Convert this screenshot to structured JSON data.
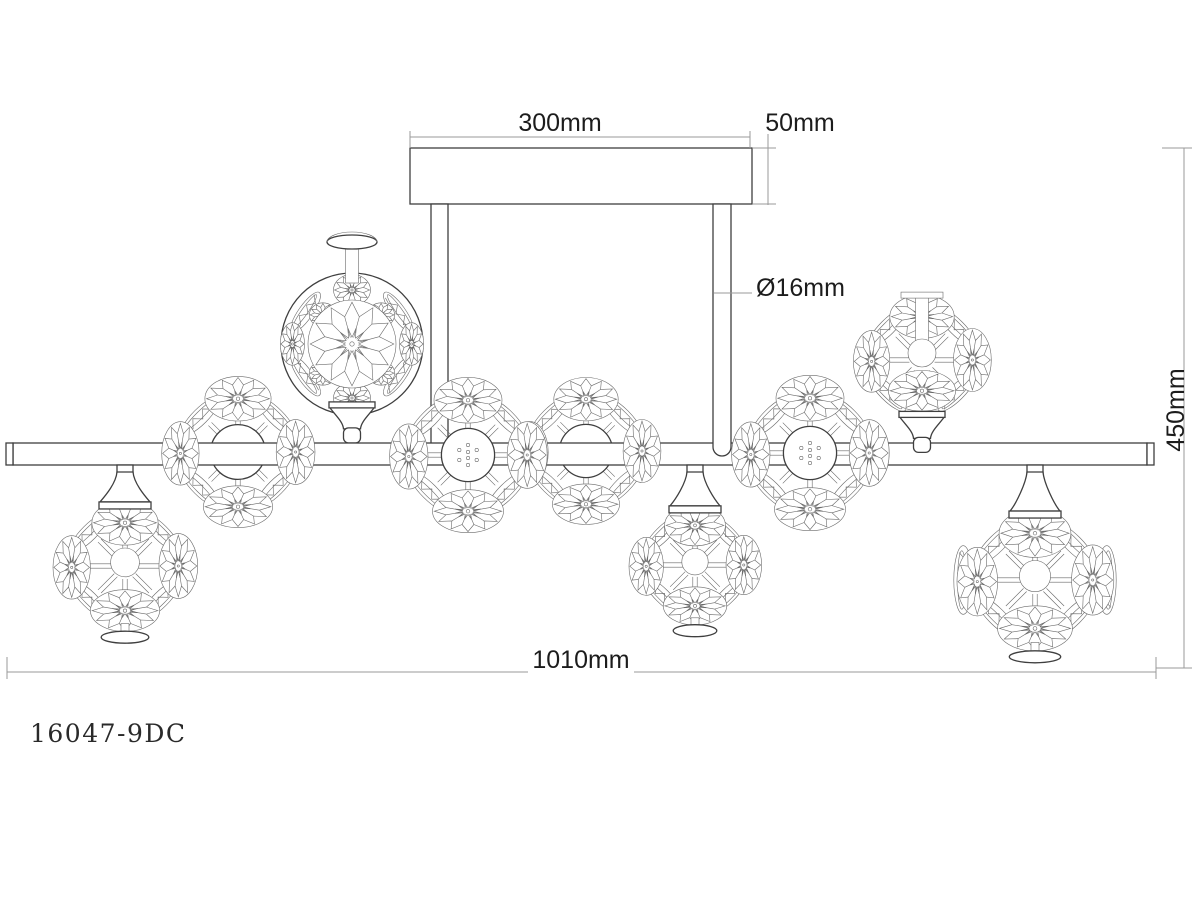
{
  "product": {
    "model_number": "16047-9DC"
  },
  "dimension_labels": {
    "canopy_width": "300mm",
    "canopy_height": "50mm",
    "rod_diameter": "Ø16mm",
    "fixture_height": "450mm",
    "fixture_width": "1010mm"
  },
  "drawing": {
    "colors": {
      "outline": "#3f3f3f",
      "detail": "#6a6a6a",
      "dimension": "#9a9a9a",
      "text": "#1c1c1c"
    },
    "canopy": {
      "x": 410,
      "y": 148,
      "w": 342,
      "h": 56
    },
    "rods": [
      {
        "x": 431,
        "w": 17,
        "top": 204,
        "bottom": 444,
        "cap": false
      },
      {
        "x": 713,
        "w": 18,
        "top": 204,
        "bottom": 447,
        "cap": true
      }
    ],
    "bar": {
      "x1": 6,
      "x2": 1154,
      "y1": 443,
      "y2": 465,
      "cap_w": 7
    },
    "clusters": [
      {
        "type": "hang",
        "cx": 125,
        "cy": 566,
        "r": 72
      },
      {
        "type": "barball",
        "cx": 238,
        "cy": 452,
        "r": 72
      },
      {
        "type": "big",
        "cx": 352,
        "cy": 344,
        "r": 71
      },
      {
        "type": "bardots",
        "cx": 468,
        "cy": 455,
        "r": 74
      },
      {
        "type": "barball",
        "cx": 586,
        "cy": 451,
        "r": 70
      },
      {
        "type": "hang",
        "cx": 695,
        "cy": 565,
        "r": 66
      },
      {
        "type": "bardots",
        "cx": 810,
        "cy": 453,
        "r": 74
      },
      {
        "type": "stand",
        "cx": 922,
        "cy": 360,
        "r": 70
      },
      {
        "type": "hang",
        "cx": 1035,
        "cy": 580,
        "r": 78
      }
    ],
    "dims": {
      "d300": {
        "y": 137,
        "x1": 410,
        "x2": 750,
        "tx": 560,
        "ty": 131
      },
      "d50": {
        "x": 768,
        "y1": 134,
        "y2": 205,
        "ext_y1": 148,
        "ext_y2": 204,
        "ext_x1": 753,
        "ext_x2": 776,
        "tx": 800,
        "ty": 131
      },
      "d16": {
        "lx1": 714,
        "lx2": 752,
        "ly": 293,
        "tx": 756,
        "ty": 296
      },
      "d450": {
        "x": 1184,
        "y1": 148,
        "y2": 668,
        "tx": 1184,
        "ty": 410
      },
      "d1010": {
        "y": 672,
        "x1": 7,
        "x2": 1156,
        "tx": 581,
        "ty": 668
      }
    }
  }
}
